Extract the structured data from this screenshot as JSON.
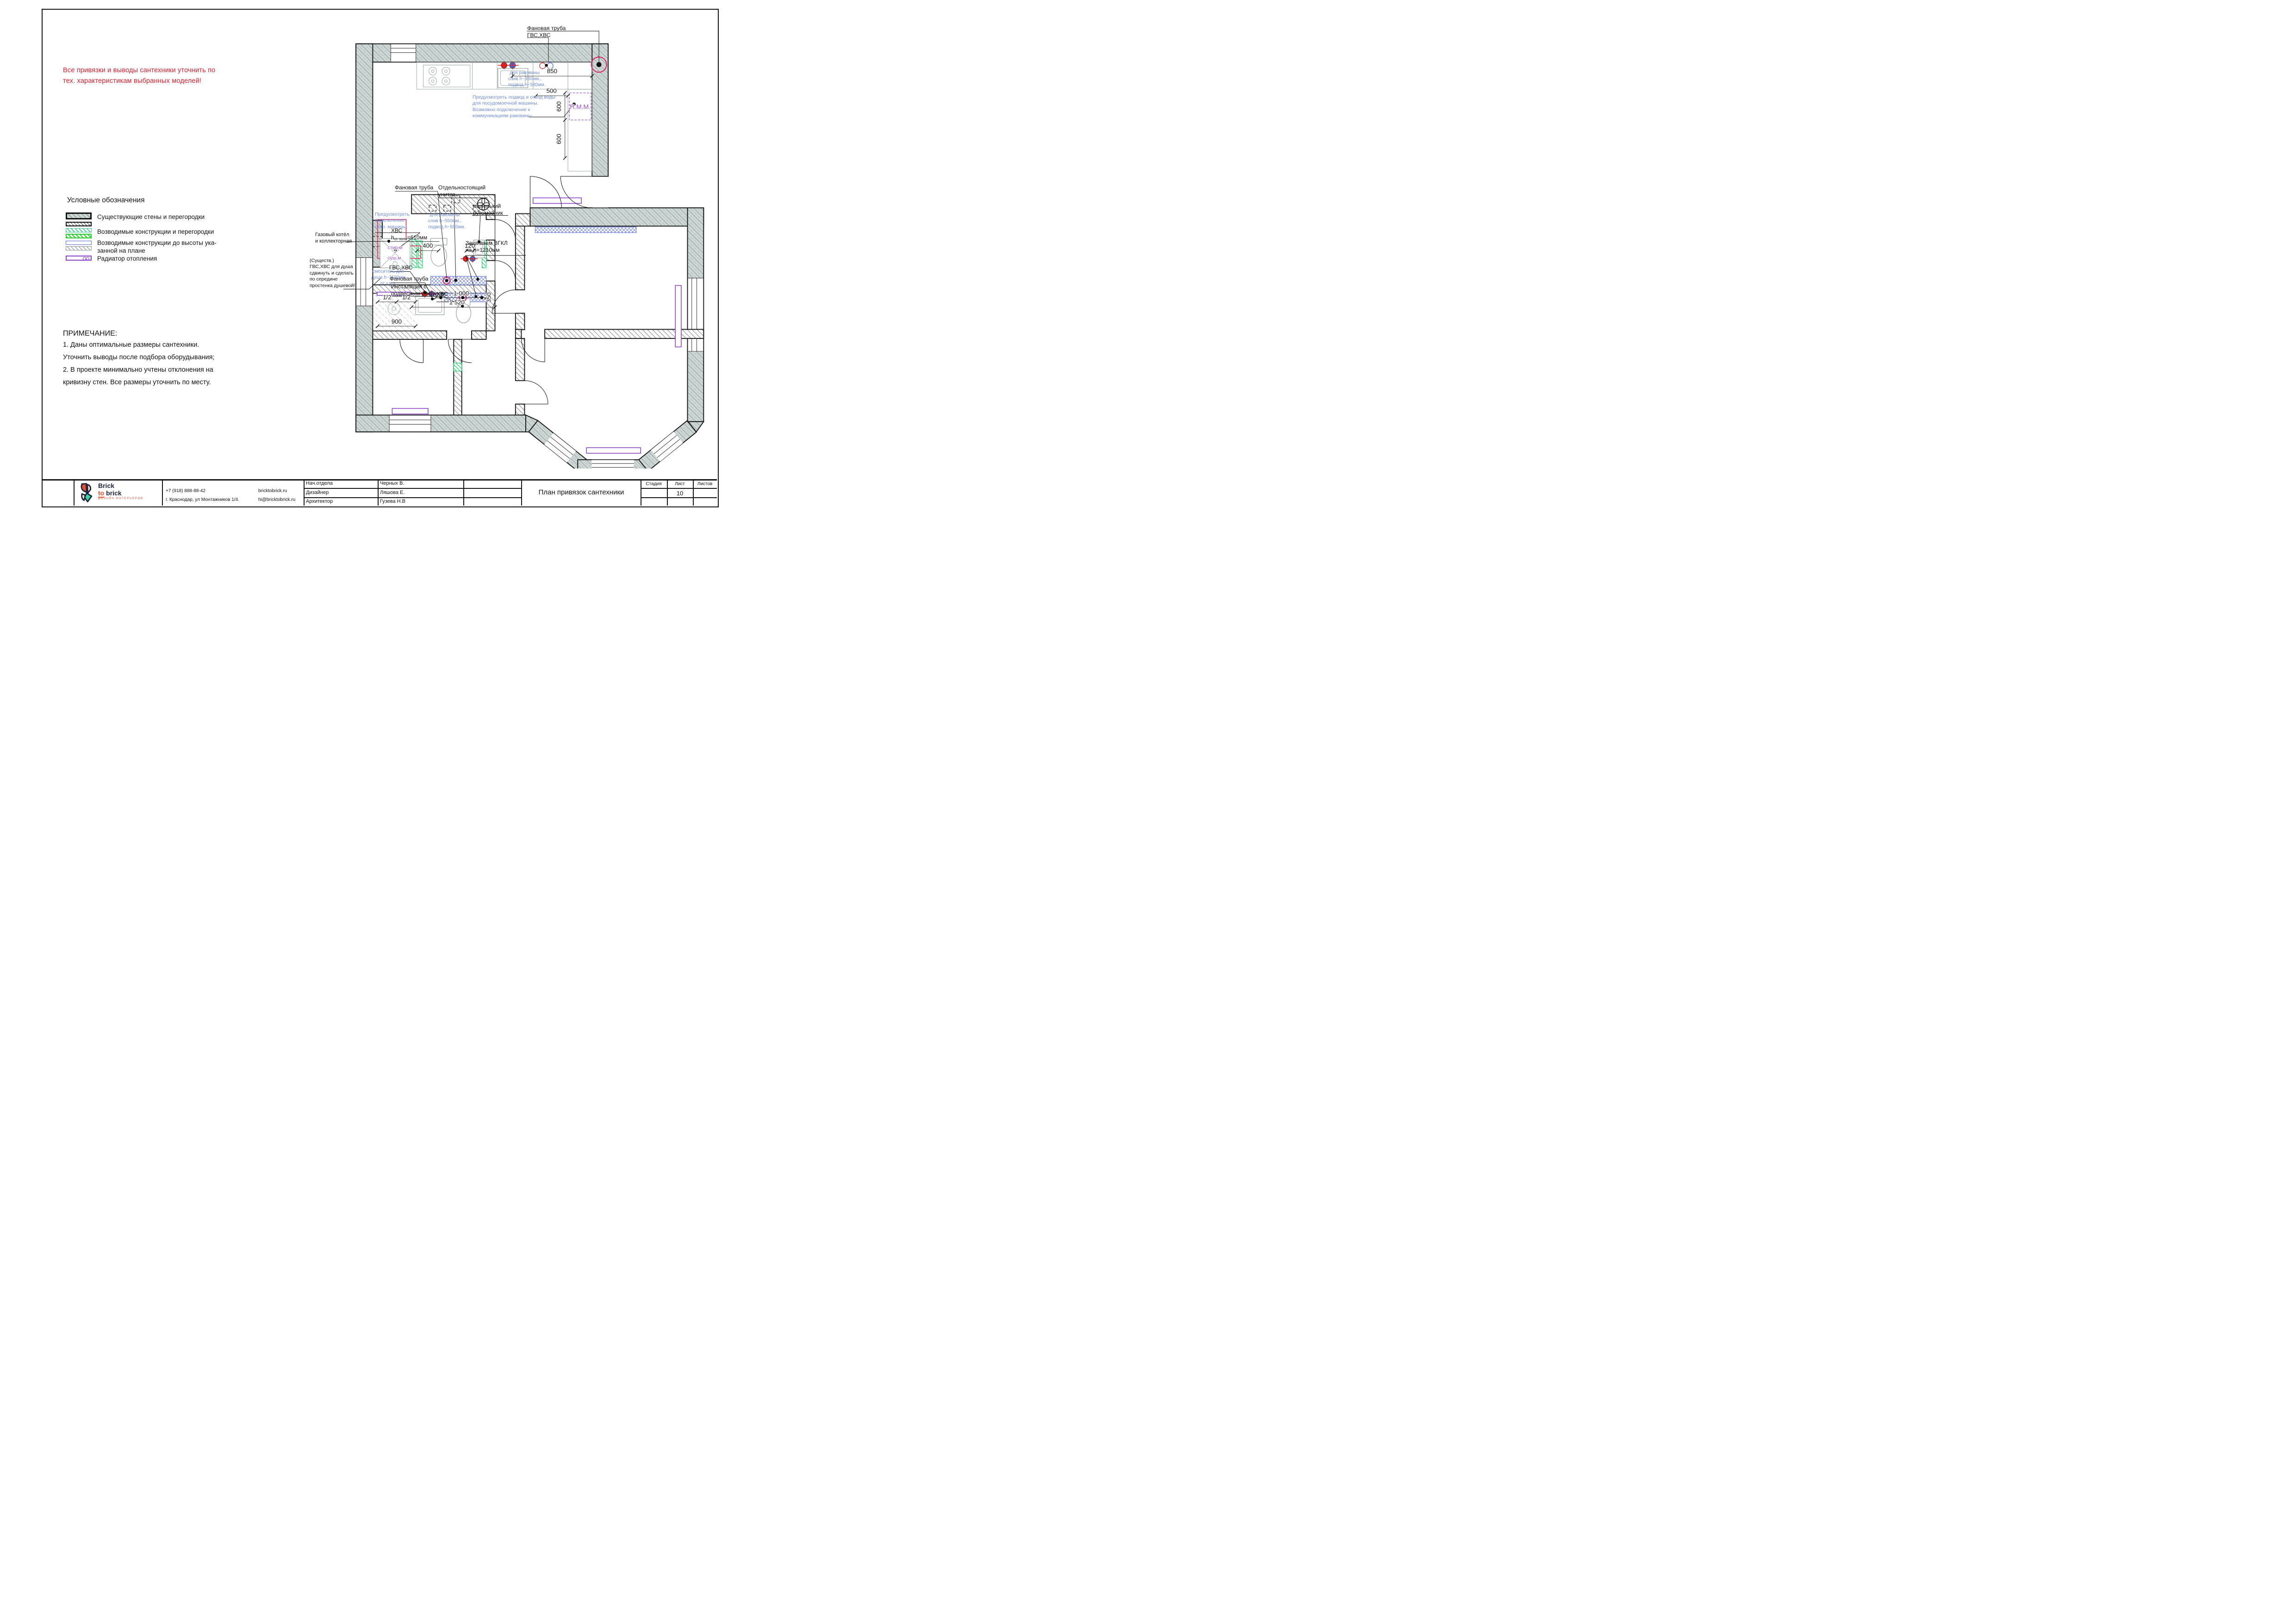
{
  "page": {
    "red_warning": [
      "Все привязки и выводы сантехники уточнить по",
      "тех. характеристикам выбранных моделей!"
    ]
  },
  "legend": {
    "title": "Условные обозначения",
    "items": [
      {
        "label": "Существующие стены и перегородки"
      },
      {
        "label": "Возводимые конструкции и перегородки"
      },
      {
        "label_line1": "Возводимые конструкции до высоты ука-",
        "label_line2": "занной на плане"
      },
      {
        "label": "Радиатор отопления"
      }
    ]
  },
  "notes": {
    "title": "ПРИМЕЧАНИЕ:",
    "lines": [
      "1. Даны оптимальные размеры сантехники.",
      "Уточнить выводы после подбора  оборудывания;",
      "2. В проекте минимально учтены отклонения на",
      "кривизну стен. Все размеры уточнить  по месту."
    ]
  },
  "plan": {
    "ann": {
      "fan_pipe_top": "Фановая труба",
      "gvs_top": "ГВС,ХВС",
      "sink_kitchen": [
        "для раковины",
        "слив h~350мм.,",
        "подвод h~580мм."
      ],
      "pmm": "П.М.М.",
      "dw_note": [
        "Предусмотреть подвод и отвод воды",
        "для посудомоечной машины.",
        "Возможно подключение к",
        "коммуникациям раковины"
      ],
      "fan_pipe_mid": "Фановая труба",
      "standalone": [
        "Отдельностоящий",
        "унитаз"
      ],
      "small_sink": [
        "маленький",
        "рукомойник"
      ],
      "washer_note": [
        "Предусмотреть",
        "подключение",
        "стир. машины."
      ],
      "sink_wc": [
        "для раковины",
        "слив h~550мм.,",
        "подвод h~580мм."
      ],
      "gas": [
        "Газовый котёл",
        "и коллекторная"
      ],
      "hvs610": {
        "l1": "ХВС",
        "h": "h",
        "sub": "от пола",
        "rest": "=610мм"
      },
      "washer": {
        "t": "стир.м",
        "p": "+",
        "b": "суш.м."
      },
      "vgkl": [
        "Зашиваем ВГКЛ",
        "на h=1210мм"
      ],
      "shower": [
        "(Существ.)",
        "ГВС,ХВС для душа",
        "сдвинуть и сделать",
        "по середине",
        "простенка душевой!"
      ],
      "mixer": [
        "смеситель для",
        "душа h~1100мм",
        "от у.ч.п."
      ],
      "gvs_bath": "ГВС,ХВС",
      "fan_pipe_bath": "Фановая труба",
      "install": [
        "Инсталяция с",
        "подвесным унитазом"
      ],
      "hvs_bath": "ХВС"
    },
    "dims": {
      "d850": "850",
      "d500": "500",
      "d600a": "600",
      "d600b": "600",
      "d400": "400",
      "d120": "120",
      "d1000": "1 000",
      "d350": "350",
      "d1520": "1 520",
      "d900": "900",
      "ha": "1/2",
      "hb": "1/2"
    }
  },
  "titleblock": {
    "brand": {
      "line1": "Brick",
      "to": "to",
      "line2": "brick",
      "subtitle": "ДИЗАЙН ИНТЕРЬЕРОВ"
    },
    "contacts": {
      "phone": "+7 (918)   888-88-42",
      "address": "г. Краснодар, ул Монтажников 1/4.",
      "site": "bricktobrick.ru",
      "email": "hi@bricktobrick.ru"
    },
    "staff": [
      {
        "role": "Нач.отдела",
        "name": "Черных В."
      },
      {
        "role": "Дизайнер",
        "name": "Ляшова Е."
      },
      {
        "role": "Архитектор",
        "name": "Гузева  Н.В"
      }
    ],
    "title": "План привязок сантехники",
    "sheet": {
      "stage_label": "Стадия",
      "sheet_label": "Лист",
      "sheets_label": "Листов",
      "sheet_value": "10"
    }
  }
}
